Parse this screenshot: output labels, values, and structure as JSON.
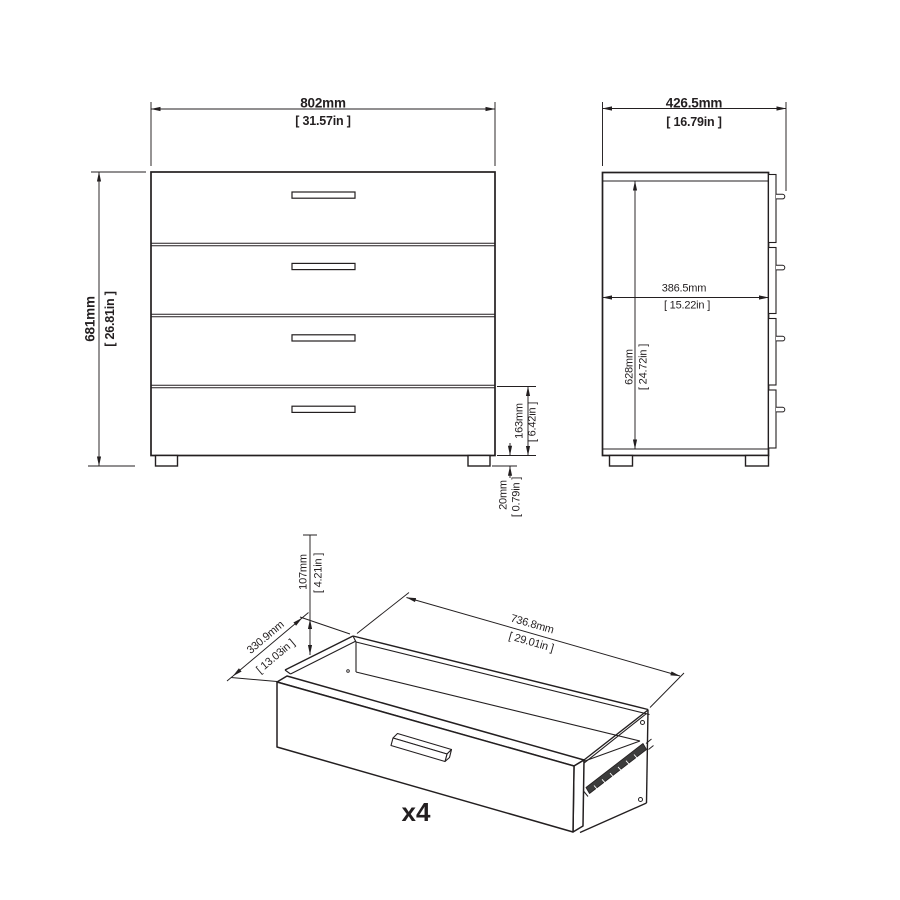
{
  "front_view": {
    "width_mm": "802mm",
    "width_in": "[ 31.57in ]",
    "height_mm": "681mm",
    "height_in": "[ 26.81in ]",
    "bottom_drawer_mm": "163mm",
    "bottom_drawer_in": "[ 6.42in ]",
    "foot_mm": "20mm",
    "foot_in": "[ 0.79in ]"
  },
  "side_view": {
    "depth_mm": "426.5mm",
    "depth_in": "[ 16.79in ]",
    "inner_depth_mm": "386.5mm",
    "inner_depth_in": "[ 15.22in ]",
    "inner_height_mm": "628mm",
    "inner_height_in": "[ 24.72in ]"
  },
  "drawer_view": {
    "height_mm": "107mm",
    "height_in": "[ 4.21in ]",
    "depth_mm": "330.9mm",
    "depth_in": "[ 13.03in ]",
    "width_mm": "736.8mm",
    "width_in": "[ 29.01in ]",
    "quantity_label": "x4"
  },
  "colors": {
    "line": "#231f20",
    "rail_fill": "#3c3c3c"
  }
}
